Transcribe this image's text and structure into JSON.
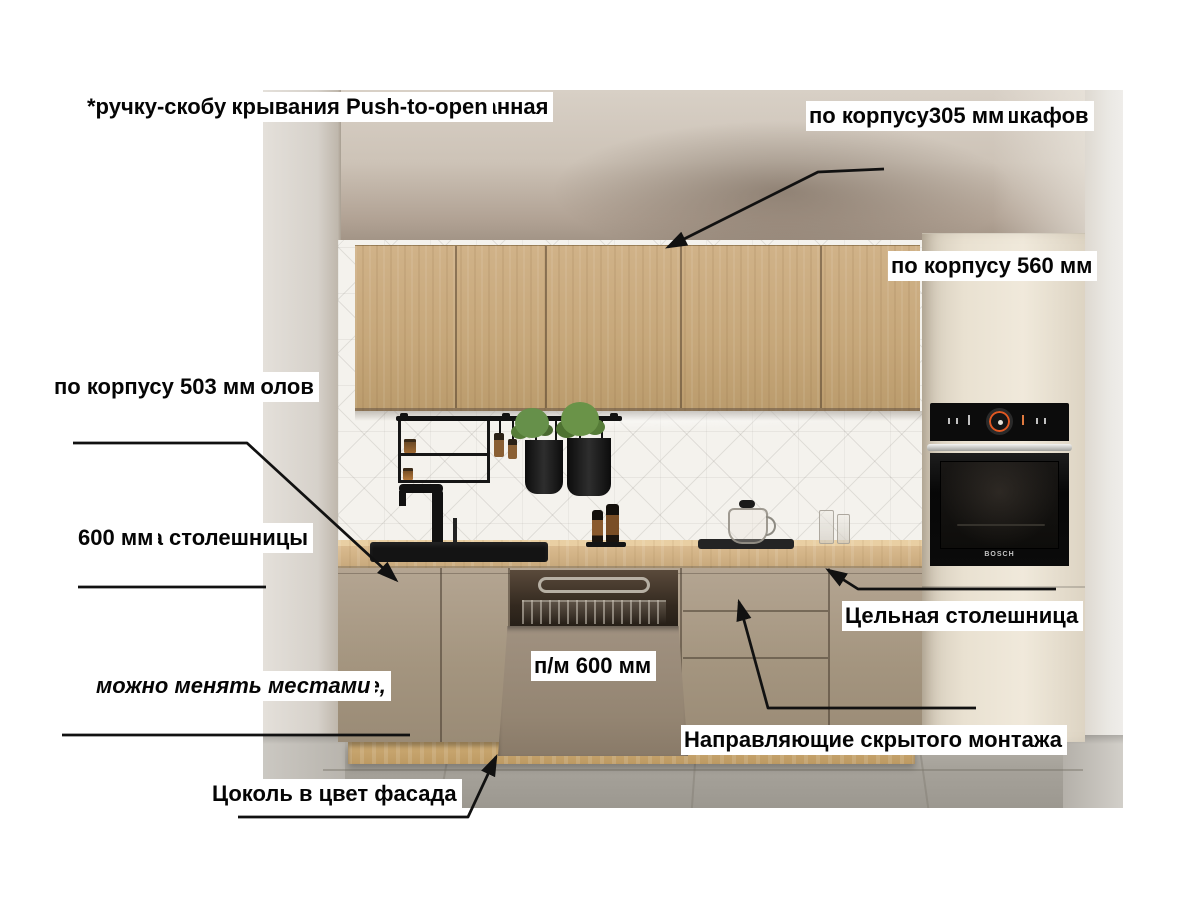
{
  "annotations": {
    "info_block": {
      "lines": [
        "Нижние шкафы — ручка интегрированная",
        "в фасад.",
        "Верхние шкафы - можно установить",
        "(приобретаются дополнительно):",
        "*накладную ручку",
        "*механизм открывания Push-to-open",
        "*ручку-скобу"
      ]
    },
    "upper_cabinet_depth": {
      "lines": [
        "Глубина верхних шкафов",
        "по корпусу305 мм"
      ]
    },
    "tall_cabinet_depth": {
      "lines": [
        "Глубина Пенала",
        "по корпусу 560 мм"
      ]
    },
    "base_cabinet_depth": {
      "lines": [
        "Глубина нижних столов",
        "по корпусу 503 мм"
      ]
    },
    "countertop_depth": {
      "lines": [
        "Глубина столешницы",
        "600 мм"
      ]
    },
    "modules_note": {
      "lines": [
        "* Все модули раздельные,",
        "можно менять местами"
      ]
    },
    "plinth": {
      "text": "Цоколь в цвет фасада"
    },
    "dishwasher_facade": {
      "lines": [
        "Фасад для",
        "п/м 600 мм"
      ]
    },
    "solid_countertop": {
      "text": "Цельная столешница"
    },
    "drawer_mechanism": {
      "lines": [
        "Механизм выдвижения ящиков -",
        "Направляющие скрытого монтажа"
      ]
    }
  },
  "appliances": {
    "oven_brand": "BOSCH"
  },
  "colors": {
    "annotation_line": "#111111",
    "label_bg": "#ffffff",
    "label_text": "#000000",
    "upper_wood": "#c5a679",
    "facade_taupe": "#a79884",
    "countertop_wood": "#d9ba8f",
    "tall_cabinet": "#ece4d4",
    "oven_display_accent": "#e25822",
    "backsplash": "#f4f2ed",
    "floor": "#a7a39c"
  }
}
